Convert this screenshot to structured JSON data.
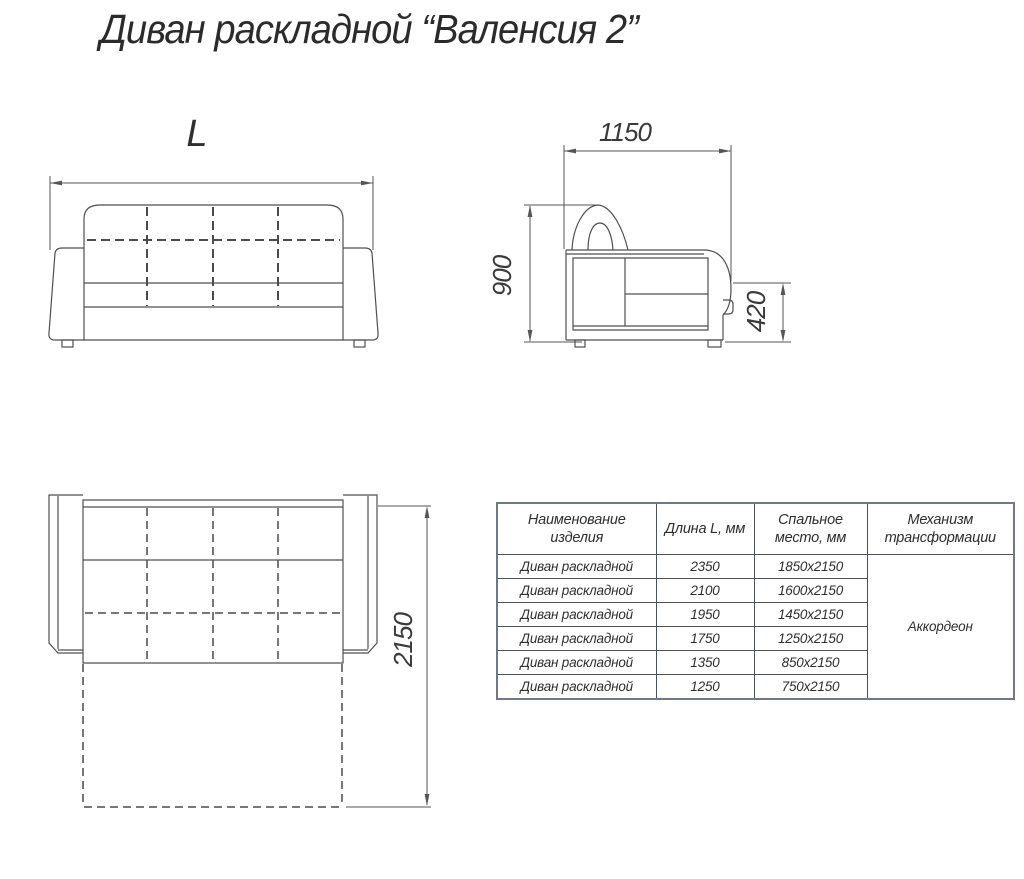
{
  "title": "Диван раскладной “Валенсия 2”",
  "front_view": {
    "length_label": "L"
  },
  "side_view": {
    "width_mm": "1150",
    "height_mm": "900",
    "seat_height_mm": "420"
  },
  "top_view_unfolded": {
    "bed_length_mm": "2150"
  },
  "table": {
    "headers": [
      "Наименование\nизделия",
      "Длина L, мм",
      "Спальное\nместо, мм",
      "Механизм\nтрансформации"
    ],
    "rows": [
      {
        "name": "Диван раскладной",
        "length": "2350",
        "sleeping": "1850x2150"
      },
      {
        "name": "Диван раскладной",
        "length": "2100",
        "sleeping": "1600x2150"
      },
      {
        "name": "Диван раскладной",
        "length": "1950",
        "sleeping": "1450x2150"
      },
      {
        "name": "Диван раскладной",
        "length": "1750",
        "sleeping": "1250x2150"
      },
      {
        "name": "Диван раскладной",
        "length": "1350",
        "sleeping": "850x2150"
      },
      {
        "name": "Диван раскладной",
        "length": "1250",
        "sleeping": "750x2150"
      }
    ],
    "mechanism": "Аккордеон"
  },
  "colors": {
    "line": "#4f4f4f",
    "dimension": "#565656",
    "text": "#2e2e2e",
    "table_border": "#707787"
  }
}
